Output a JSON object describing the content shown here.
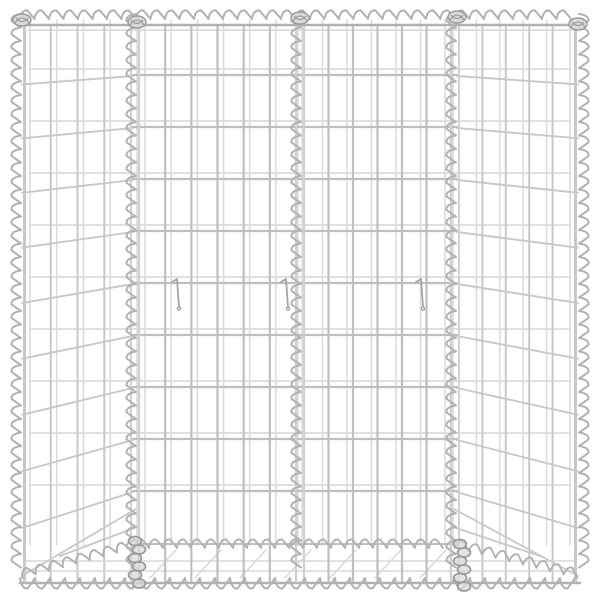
{
  "scene": {
    "description": "Product photo of a silver galvanized steel gabion wire-mesh basket (trapezium raised bed) with four mesh panels joined by spiral wire seams, on a plain white background",
    "background_color": "#ffffff",
    "canvas": {
      "width": 600,
      "height": 600
    }
  },
  "palette": {
    "wire_front": "#bfbfbf",
    "wire_rail": "#b0b0b0",
    "wire_rear": "#dcdcdc",
    "wire_side": "#c8c8c8",
    "wire_flank": "#d6d6d6",
    "wire_faint": "#d8d8d8",
    "spiral": "#b2b2b2",
    "knot_stroke": "#9a9a9a",
    "knot_fill": "#d9d9d9",
    "hook": "#a5a5a5"
  },
  "frame": {
    "left": 20,
    "right": 580,
    "top_rail_y": 25,
    "bottom_rail_y": 583,
    "rear_top_rail_y": 30,
    "edge_axis_left_x": 25,
    "edge_axis_right_x": 575
  },
  "grid": {
    "row_start": 75,
    "row_step": 52,
    "row_end": 491,
    "floor_row_y": 544,
    "front_panels": [
      [
        135,
        300
      ],
      [
        300,
        455
      ]
    ],
    "side_panels": [
      [
        20,
        135
      ],
      [
        455,
        580
      ]
    ],
    "vertical_spacing": 26.5,
    "vertical_top": 27,
    "vertical_bottom": 582,
    "rear": {
      "dx": 6,
      "x0": 30,
      "x1": 570,
      "dy": -6,
      "top": 20,
      "bottom": 545
    },
    "side_slope": {
      "base": 8,
      "gain": 40,
      "exp": 1.6
    }
  },
  "spirals": {
    "vertical": {
      "xs": [
        20,
        135,
        300,
        455,
        580
      ],
      "y0": 14,
      "y1": 578,
      "step": 13.5,
      "amp": 9,
      "right_loop_x": 580,
      "flank_offset": 4,
      "inner_xs": [
        135,
        300,
        455
      ]
    },
    "top": {
      "y": 18,
      "x0": 20,
      "x1": 580,
      "step": 14.5,
      "amp": 8
    },
    "bottom": {
      "y": 579,
      "x0": 20,
      "x1": 580,
      "step": 15,
      "amp": 10
    },
    "floor": {
      "points": [
        [
          22,
          577
        ],
        [
          135,
          547
        ],
        [
          455,
          547
        ],
        [
          578,
          577
        ]
      ],
      "step": 14,
      "amp": 8
    }
  },
  "floor": {
    "mid_wires_y": [
      561,
      571
    ],
    "mid_x0": 26,
    "mid_x1": 574,
    "diagonals": {
      "x_start": 150,
      "x_end": 420,
      "step": 45,
      "dx": 26,
      "y_low": 578,
      "y_high": 550
    },
    "corner_diagonals": [
      [
        22,
        576,
        136,
        509
      ],
      [
        578,
        576,
        454,
        509
      ],
      [
        60,
        556,
        137,
        527
      ],
      [
        540,
        556,
        453,
        527
      ]
    ]
  },
  "hooks": [
    {
      "x": 178,
      "y": 280
    },
    {
      "x": 287,
      "y": 280
    },
    {
      "x": 422,
      "y": 280
    }
  ],
  "knots": {
    "top": [
      [
        22,
        20
      ],
      [
        137,
        22
      ],
      [
        300,
        18
      ],
      [
        457,
        17
      ],
      [
        578,
        24
      ]
    ],
    "bottom": [
      [
        137,
        562
      ],
      [
        462,
        565
      ]
    ]
  }
}
